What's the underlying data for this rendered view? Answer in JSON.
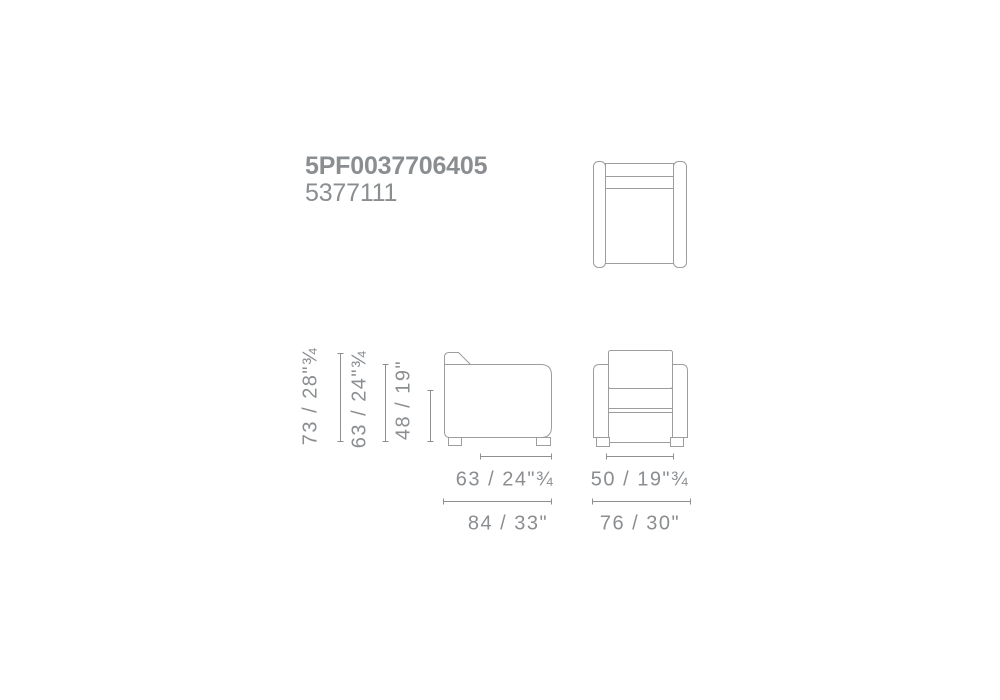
{
  "header": {
    "product_code": "5PF0037706405",
    "variant_code": "5377111"
  },
  "colors": {
    "bg": "#ffffff",
    "line": "#9d9d9d",
    "dim": "#8f8f8f",
    "text": "#8b8e91"
  },
  "dimensions": {
    "vertical": [
      {
        "id": "total-height",
        "label": "73 / 28\"¾",
        "cm": "73",
        "inches": "28¾"
      },
      {
        "id": "arm-height",
        "label": "63 / 24\"¾",
        "cm": "63",
        "inches": "24¾"
      },
      {
        "id": "seat-height",
        "label": "48 / 19\"",
        "cm": "48",
        "inches": "19"
      }
    ],
    "depth": [
      {
        "id": "seat-depth",
        "label": "63 / 24\"¾",
        "cm": "63",
        "inches": "24¾"
      },
      {
        "id": "total-depth",
        "label": "84 / 33\"",
        "cm": "84",
        "inches": "33"
      }
    ],
    "width": [
      {
        "id": "seat-width",
        "label": "50 / 19\"¾",
        "cm": "50",
        "inches": "19¾"
      },
      {
        "id": "total-width",
        "label": "76 / 30\"",
        "cm": "76",
        "inches": "30"
      }
    ]
  }
}
